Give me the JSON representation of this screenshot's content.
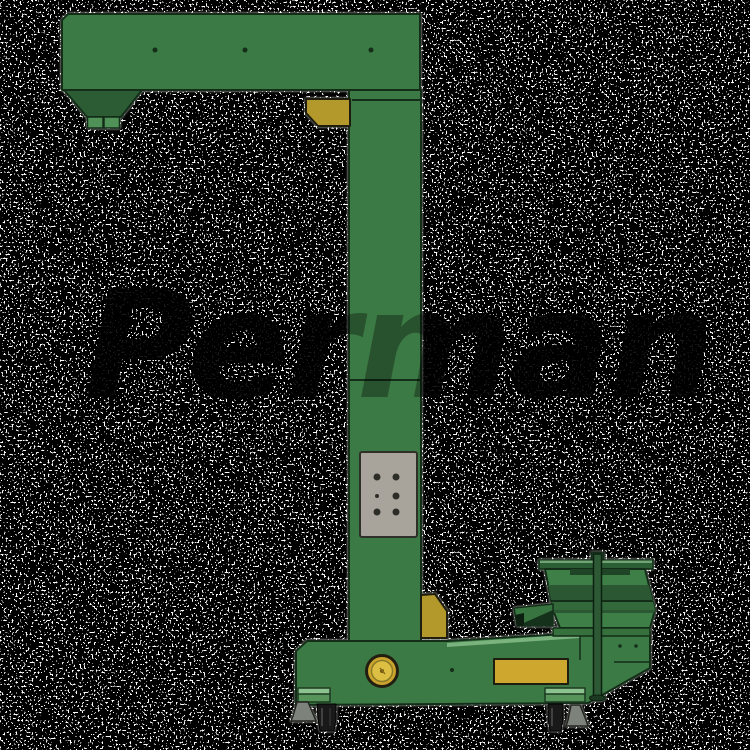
{
  "watermark": {
    "text": "Perman"
  },
  "colors": {
    "background": "#000000",
    "noise_dot": "#ffffff",
    "machine_green": "#3b7a44",
    "dark_green": "#2b5c33",
    "light_green_edge": "#7ab37e",
    "outlet_green": "#4f9156",
    "gusset_yellow": "#b3982b",
    "accent_yellow": "#d9bc3a",
    "plate_yellow": "#cda72e",
    "panel_gray": "#a8a49b",
    "outline": "#132d18",
    "caster_black": "#191919",
    "foot_gray": "#7d837b"
  }
}
